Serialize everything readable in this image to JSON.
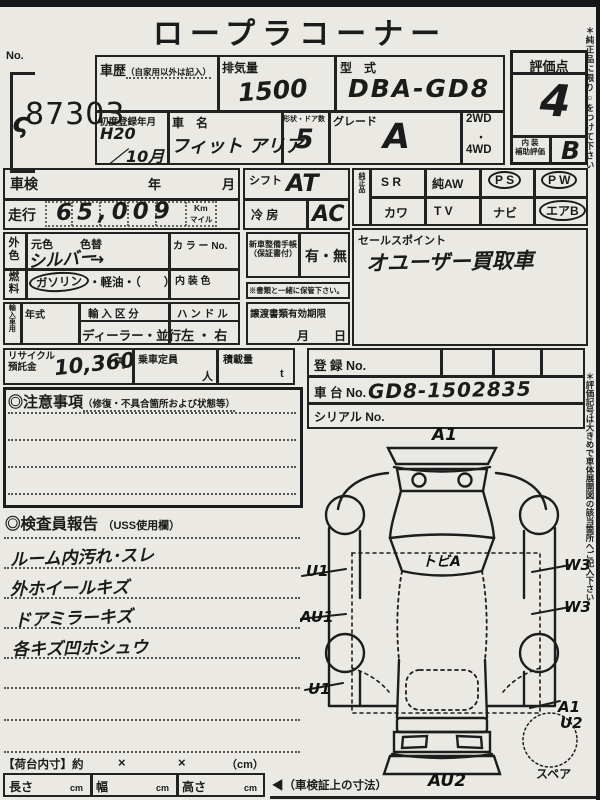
{
  "title": "ロープラコーナー",
  "lot": {
    "label": "No.",
    "squiggle": "ς",
    "number": "87303"
  },
  "top": {
    "history_label": "車歴",
    "history_note": "（自家用以外は記入）",
    "disp_label": "排気量",
    "disp_value": "1500",
    "model_label": "型　式",
    "model_value": "DBA-GD8",
    "firstreg_label": "初度登録年月",
    "firstreg_value1": "H20",
    "firstreg_value2": "／10月",
    "name_label": "車　名",
    "name_value": "フィット アリア",
    "shape_label": "形状・ドア数",
    "shape_value": "5",
    "grade_label": "グレード",
    "grade_value": "A",
    "wd2": "2WD",
    "wd_dot": "・",
    "wd4": "4WD"
  },
  "score": {
    "label": "評価点",
    "value": "4",
    "interior_label1": "内 装",
    "interior_label2": "補助評価",
    "interior_value": "B"
  },
  "row2": {
    "shaken_label": "車検",
    "year": "年",
    "month": "月",
    "mileage_label": "走行",
    "mileage_value": "65,009",
    "unit_top": "Km",
    "unit_bottom": "マイル",
    "shift_label": "シフト",
    "shift_value": "AT",
    "cool_label": "冷 房",
    "cool_value": "AC"
  },
  "genuine": {
    "label": "純正品",
    "r1": [
      "S R",
      "純AW",
      "P S",
      "P W"
    ],
    "r2": [
      "カワ",
      "T V",
      "ナビ",
      "エアB"
    ]
  },
  "sales": {
    "label": "セールスポイント",
    "value": "オユーザー買取車"
  },
  "color": {
    "label1": "外",
    "label2": "色",
    "orig_label": "元色",
    "orig_value": "シルバー",
    "change_label": "色替",
    "change_value": "→",
    "colorno_label": "カ ラ ー No."
  },
  "fuel": {
    "label1": "燃",
    "label2": "料",
    "value": "ガソリン",
    "rest": "・軽油・（　　）",
    "interior_label": "内 装 色"
  },
  "import": {
    "label": "輸入車用",
    "year_label": "年式",
    "kubun_label": "輸 入 区 分",
    "kubun_value": "ディーラー・並行",
    "handle_label": "ハ ン ド ル",
    "handle_value": "左 ・ 右"
  },
  "docs": {
    "book_label1": "新車整備手帳",
    "book_label2": "（保証書付）",
    "book_value": "有・無",
    "keep_note": "※書類と一緒に保管下さい。",
    "transfer_label": "譲渡書類有効期限",
    "month": "月",
    "day": "日"
  },
  "recycle": {
    "label1": "リサイクル",
    "label2": "預託金",
    "value": "10,360",
    "unit": "円",
    "pax_label": "乗車定員",
    "pax_unit": "人",
    "load_label": "積載量",
    "load_unit": "t"
  },
  "reg": {
    "reg_label": "登 録 No.",
    "chassis_label": "車 台 No.",
    "chassis_value": "GD8-1502835",
    "serial_label": "シリアル No."
  },
  "caution": {
    "title": "◎注意事項",
    "subtitle": "（修復・不具合箇所および状態等）"
  },
  "inspector": {
    "title": "◎検査員報告",
    "subtitle": "（USS使用欄）",
    "lines": [
      "ルーム内汚れ･スレ",
      "外ホイールキズ",
      "ドアミラーキズ",
      "各キズ凹ホシュウ"
    ]
  },
  "diagram": {
    "front": "A1",
    "windshield": "トビA",
    "left1": "U1",
    "left2": "AU1",
    "left3": "U1",
    "right1": "W3",
    "right2": "W3",
    "right3": "A1",
    "right4": "U2",
    "rear": "AU2",
    "spare": "スペア"
  },
  "bed": {
    "label": "【荷台内寸】約",
    "x1": "×",
    "x2": "×",
    "unit": "（cm）",
    "len_label": "長さ",
    "wid_label": "幅",
    "hei_label": "高さ",
    "cm": "cm",
    "note": "◀（車検証上の寸法）"
  },
  "side_notes": {
    "n1": "＊純正品に限り○をつけて下さい",
    "n2": "＊評価記号は大きめで車体展開図の該当箇所へご記入下さい"
  }
}
